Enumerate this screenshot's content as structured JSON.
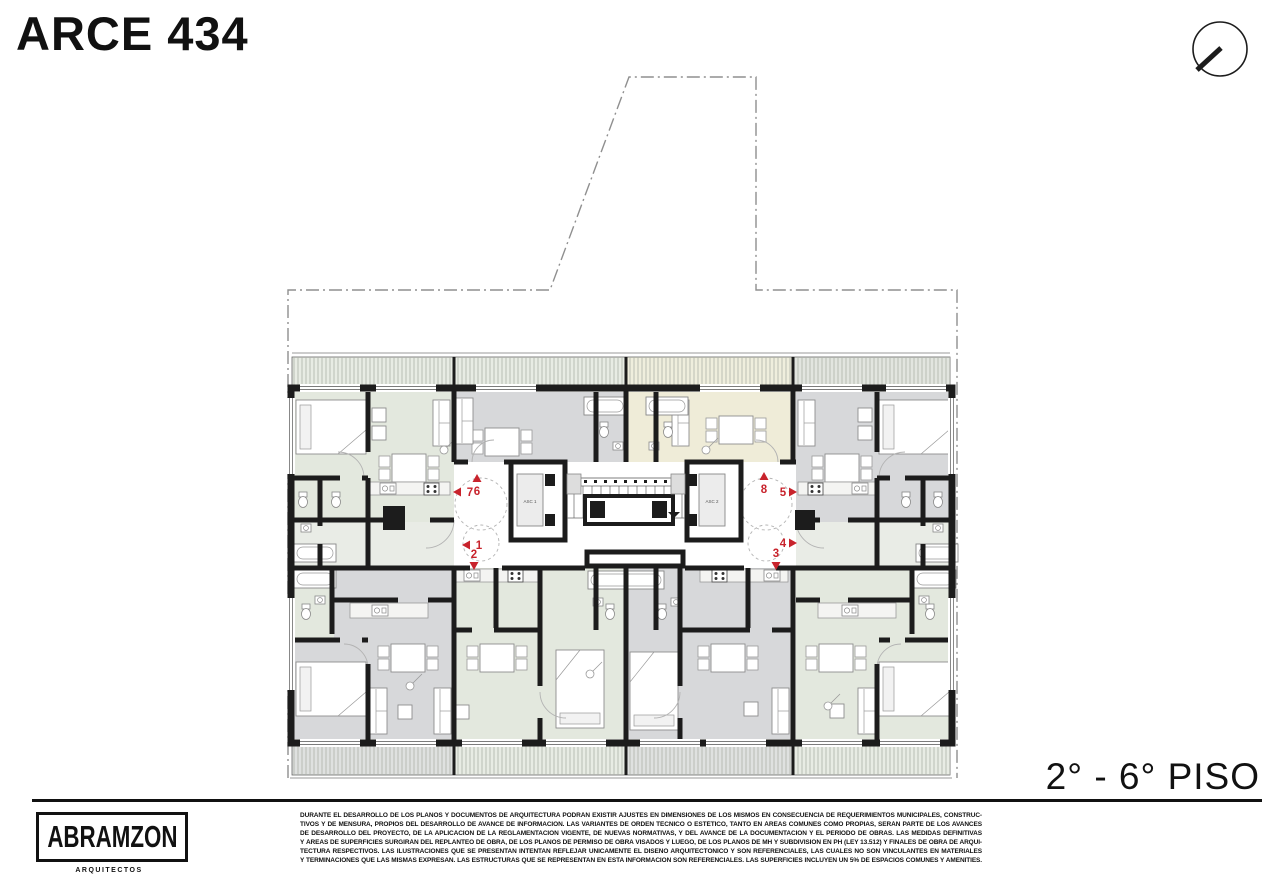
{
  "title": "ARCE 434",
  "floor_label": "2° - 6° PISO",
  "firm": {
    "name": "ABRAMZON",
    "subtitle": "ARQUITECTOS"
  },
  "disclaimer": {
    "lines": [
      "DURANTE EL DESARROLLO DE LOS PLANOS Y DOCUMENTOS DE ARQUITECTURA PODRÁN EXISTIR AJUSTES EN DIMENSIONES DE LOS MISMOS EN CONSECUENCIA DE REQUERIMIENTOS MUNICIPALES, CONSTRUC-",
      "TIVOS Y DE MENSURA, PROPIOS DEL DESARROLLO DE AVANCE DE INFORMACIÓN. LAS VARIANTES DE ORDEN TÉCNICO O ESTÉTICO, TANTO EN ÁREAS COMUNES COMO PROPIAS, SERÁN PARTE DE LOS AVANCES",
      "DE DESARROLLO DEL PROYECTO, DE LA APLICACIÓN DE LA REGLAMENTACIÓN VIGENTE, DE NUEVAS NORMATIVAS, Y DEL AVANCE DE LA DOCUMENTACIÓN Y EL PERÍODO DE OBRAS. LAS MEDIDAS DEFINITIVAS",
      "Y ÁREAS DE SUPERFICIES SURGIRÁN DEL REPLANTEO DE OBRA, DE LOS PLANOS DE PERMISO DE OBRA VISADOS Y LUEGO, DE LOS PLANOS DE MH Y SUBDIVISIÓN EN PH (LEY 13.512) Y FINALES DE OBRA DE ARQUI-",
      "TECTURA RESPECTIVOS. LAS ILUSTRACIONES QUE SE PRESENTAN INTENTAN REFLEJAR ÚNICAMENTE EL DISEÑO ARQUITECTÓNICO Y SON REFERENCIALES, LAS CUALES NO SON VINCULANTES EN MATERIALES",
      "Y TERMINACIONES QUE LAS MISMAS EXPRESAN. LAS ESTRUCTURAS QUE SE REPRESENTAN EN ESTA INFORMACIÓN SON REFERENCIALES. LAS SUPERFICIES INCLUYEN UN 5% DE ESPACIOS COMUNES Y AMENITIES."
    ]
  },
  "plan": {
    "elevators": {
      "left": "ASC 1",
      "right": "ASC 2"
    },
    "unit_markers": [
      {
        "number": "1",
        "direction": "left"
      },
      {
        "number": "2",
        "direction": "down"
      },
      {
        "number": "3",
        "direction": "down"
      },
      {
        "number": "4",
        "direction": "right"
      },
      {
        "number": "5",
        "direction": "right"
      },
      {
        "number": "6",
        "direction": "up"
      },
      {
        "number": "7",
        "direction": "left"
      },
      {
        "number": "8",
        "direction": "up"
      }
    ],
    "colors": {
      "wall": "#1c1c1c",
      "marker_red": "#c8232c",
      "room_sage": "#e3e8de",
      "room_gray": "#d7d8da",
      "room_cream": "#efecd8"
    }
  }
}
